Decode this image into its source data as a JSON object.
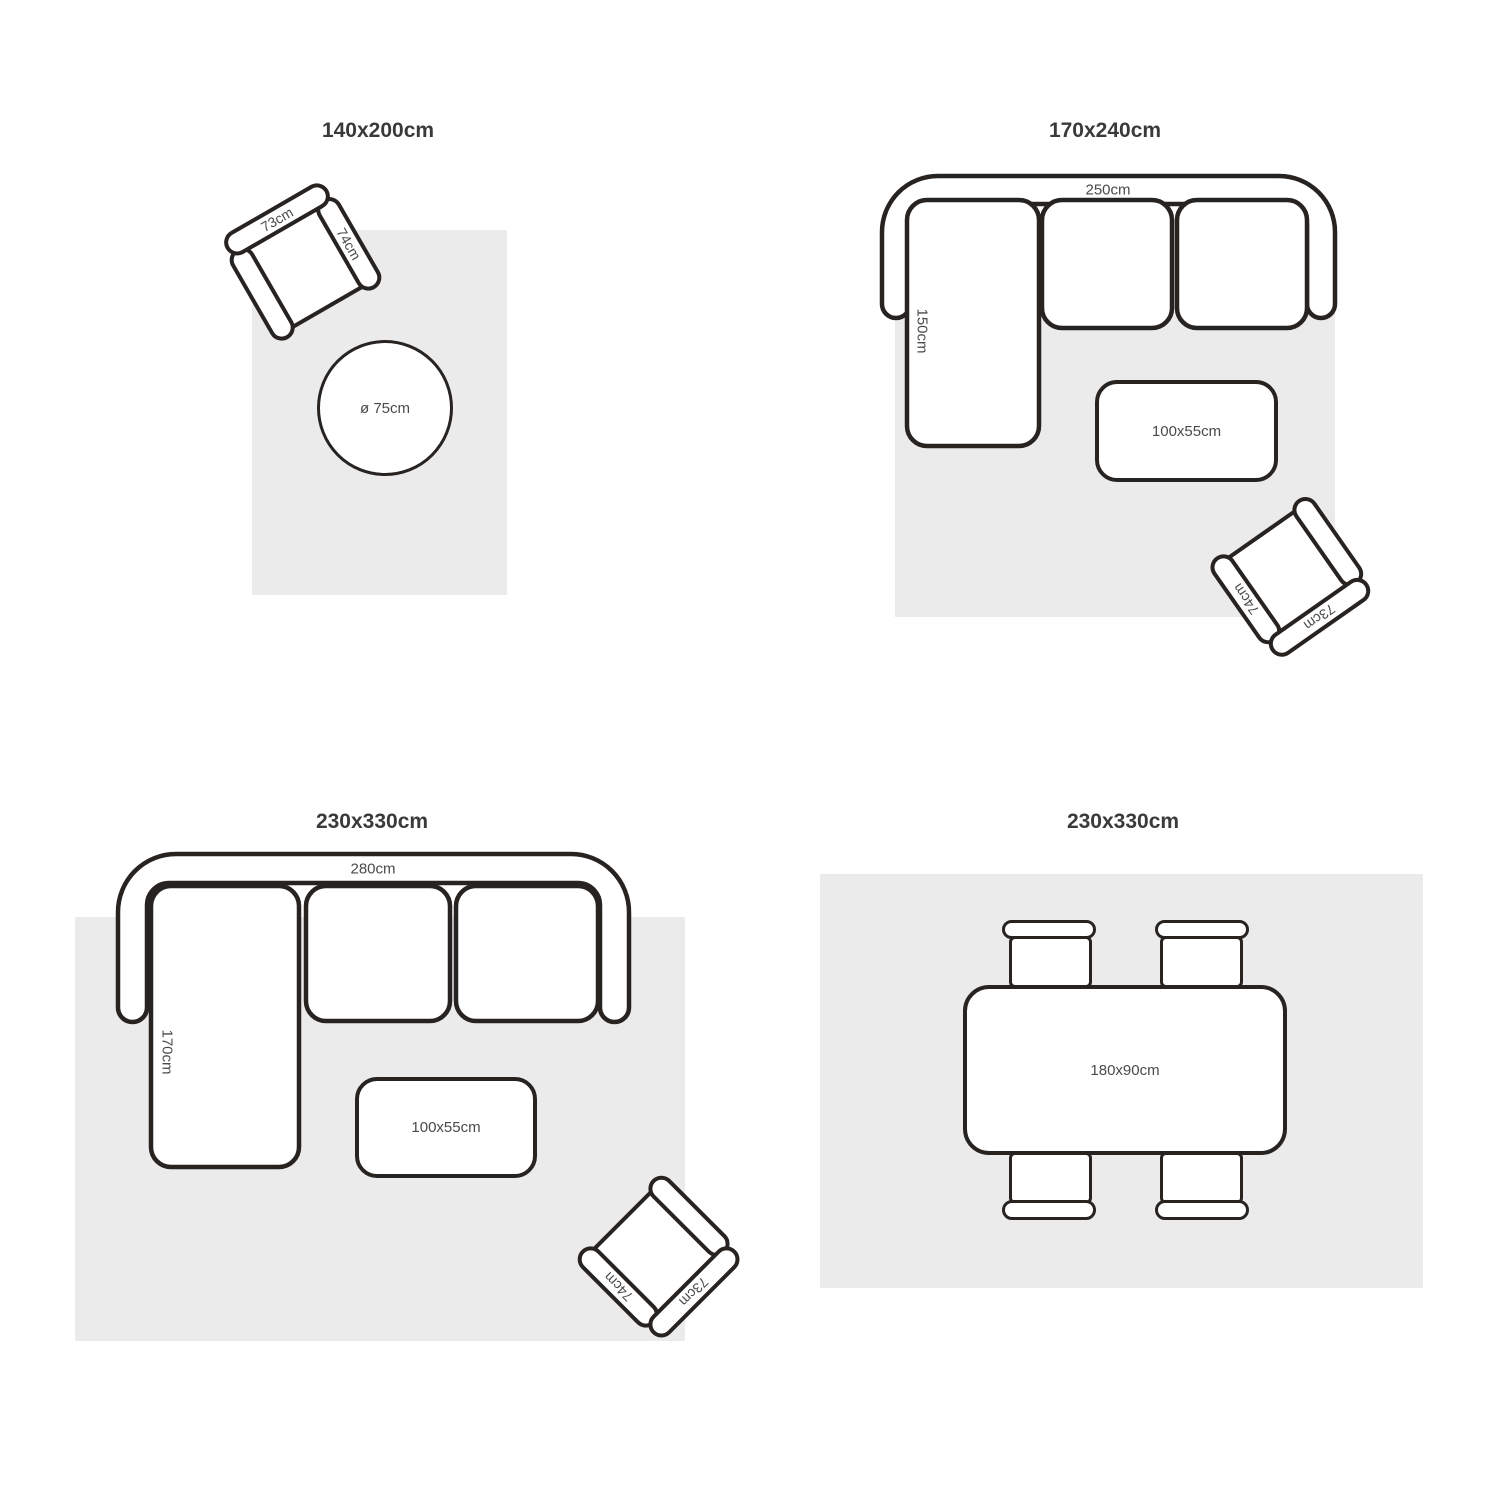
{
  "colors": {
    "background": "#ffffff",
    "line": "#272321",
    "rug": "#ebebeb",
    "title": "#3a3a3a",
    "label": "#4a4a4a"
  },
  "quadrants": [
    {
      "title": "140x200cm",
      "armchair": {
        "back_label": "73cm",
        "arm_label": "74cm"
      },
      "round_table_label": "ø 75cm"
    },
    {
      "title": "170x240cm",
      "sofa": {
        "width_label": "250cm",
        "depth_label": "150cm"
      },
      "coffee_table_label": "100x55cm",
      "armchair": {
        "back_label": "73cm",
        "arm_label": "74cm"
      }
    },
    {
      "title": "230x330cm",
      "sofa": {
        "width_label": "280cm",
        "depth_label": "170cm"
      },
      "coffee_table_label": "100x55cm",
      "armchair": {
        "back_label": "73cm",
        "arm_label": "74cm"
      }
    },
    {
      "title": "230x330cm",
      "dining_table_label": "180x90cm"
    }
  ]
}
